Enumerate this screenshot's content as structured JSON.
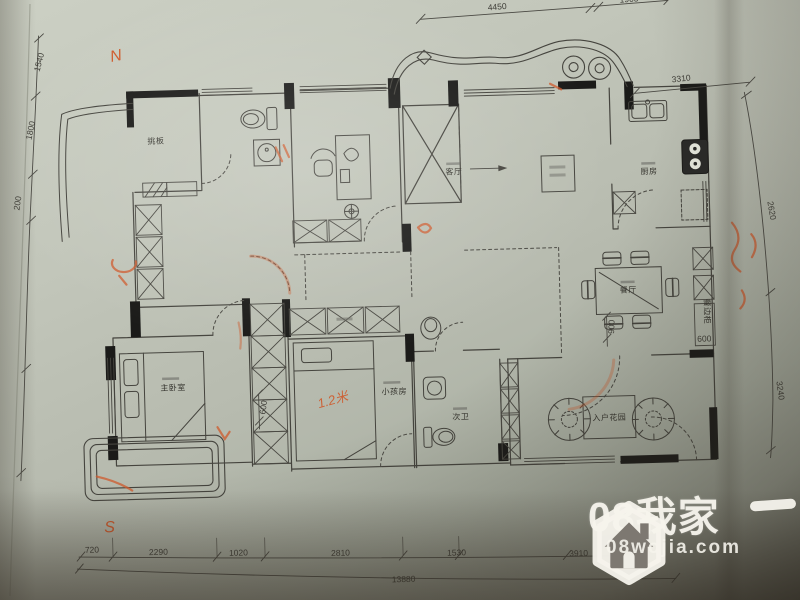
{
  "photo": {
    "description": "photographed architectural floor plan on paper"
  },
  "rooms": {
    "tiaoban": "挑板",
    "living": "客厅",
    "kitchen": "厨房",
    "dining": "餐厅",
    "master": "主卧室",
    "kids": "小孩房",
    "bath": "次卫",
    "entry_garden": "入户花园",
    "sideboard": "餐边柜"
  },
  "dims": {
    "top": [
      "4450",
      "1905"
    ],
    "left": [
      "1540",
      "1800",
      "200"
    ],
    "right": [
      "3310",
      "2620",
      "3240"
    ],
    "bottom": [
      "720",
      "2290",
      "1020",
      "2810",
      "1530",
      "3910"
    ],
    "bottom_total": "13880",
    "wardrobe": "600",
    "dining_depth": "900",
    "sideboard_depth": "600"
  },
  "annotations": {
    "north": "N",
    "south": "S",
    "bed_note": "1.2米"
  },
  "watermark": {
    "brand": "08我家",
    "site": "08wojia.com"
  }
}
